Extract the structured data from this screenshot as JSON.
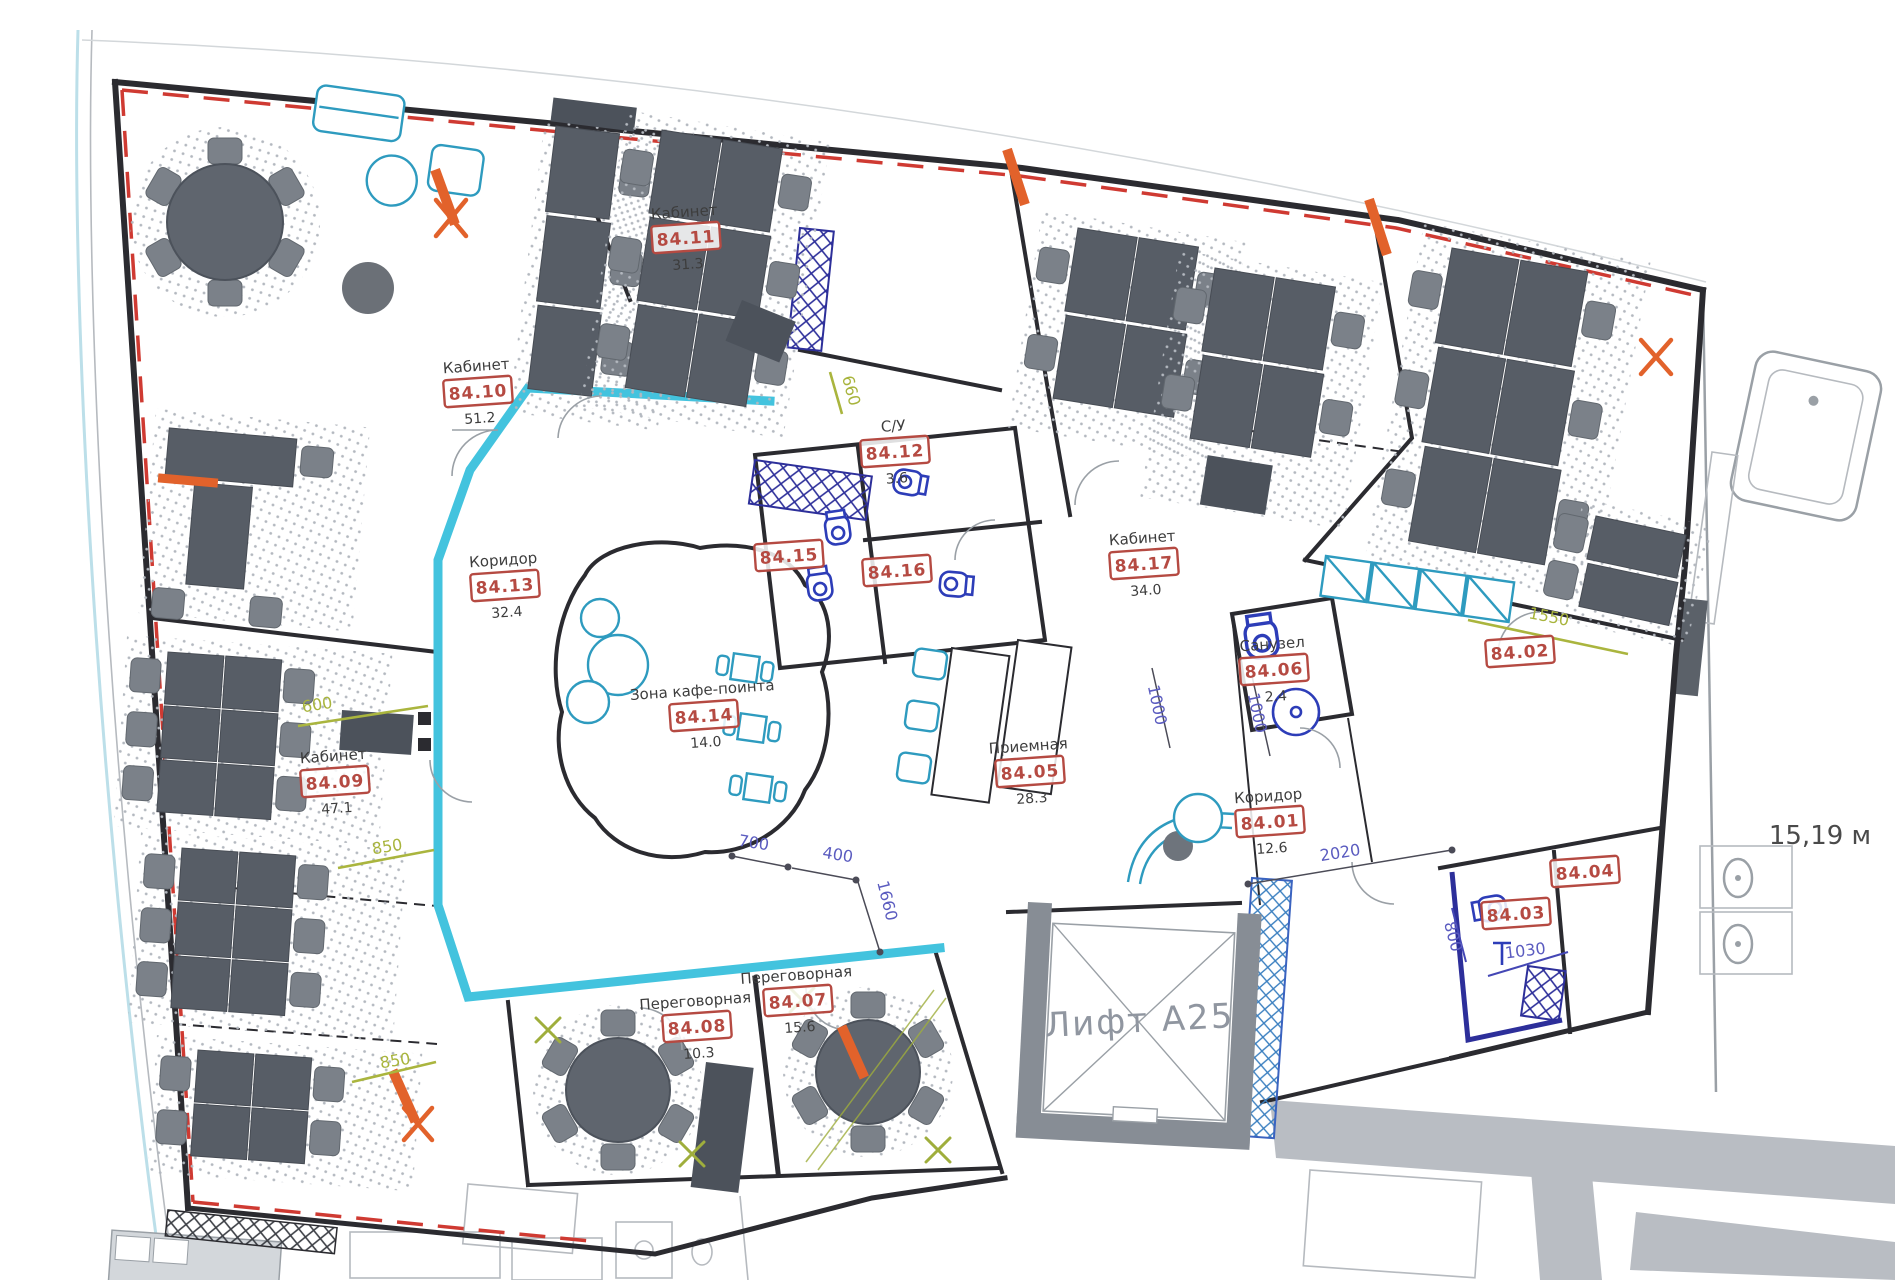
{
  "drawing": {
    "type": "office floor plan",
    "elevator_label": "Лифт А25",
    "right_note": "15,19 м"
  },
  "colors": {
    "wall": "#2b2b30",
    "cyan_wall": "#43c3de",
    "red_label": "#b54a42",
    "red_dashed_boundary": "#cf3a32",
    "orange_marker": "#e2622b",
    "navy_partition": "#2d2f9a",
    "blue_fixture": "#2d3db8",
    "olive_dimension": "#a8b43c",
    "purple_dimension": "#5b5cc0",
    "furniture_dark": "#575d66",
    "neighbor_gray": "#b9bdc3"
  },
  "rooms": [
    {
      "name": "Кабинет",
      "number": "84.11",
      "area": "31.3"
    },
    {
      "name": "Кабинет",
      "number": "84.10",
      "area": "51.2"
    },
    {
      "name": "С/У",
      "number": "84.12",
      "area": "3.6"
    },
    {
      "number": "84.15"
    },
    {
      "number": "84.16"
    },
    {
      "name": "Кабинет",
      "number": "84.17",
      "area": "34.0"
    },
    {
      "name": "Санузел",
      "number": "84.06",
      "area": "2.4"
    },
    {
      "number": "84.02"
    },
    {
      "name": "Коридор",
      "number": "84.13",
      "area": "32.4"
    },
    {
      "name": "Зона кафе-поинта",
      "number": "84.14",
      "area": "14.0"
    },
    {
      "name": "Кабинет",
      "number": "84.09",
      "area": "47.1"
    },
    {
      "name": "Приемная",
      "number": "84.05",
      "area": "28.3"
    },
    {
      "name": "Коридор",
      "number": "84.01",
      "area": "12.6"
    },
    {
      "number": "84.04"
    },
    {
      "number": "84.03"
    },
    {
      "name": "Переговорная",
      "number": "84.08",
      "area": "10.3"
    },
    {
      "name": "Переговорная",
      "number": "84.07",
      "area": "15.6"
    }
  ],
  "dimensions": [
    {
      "text": "700"
    },
    {
      "text": "400"
    },
    {
      "text": "1660"
    },
    {
      "text": "2020"
    },
    {
      "text": "1000"
    },
    {
      "text": "1000"
    },
    {
      "text": "800"
    },
    {
      "text": "1030"
    },
    {
      "text": "600"
    },
    {
      "text": "850"
    },
    {
      "text": "850"
    },
    {
      "text": "1550"
    },
    {
      "text": "660"
    }
  ]
}
